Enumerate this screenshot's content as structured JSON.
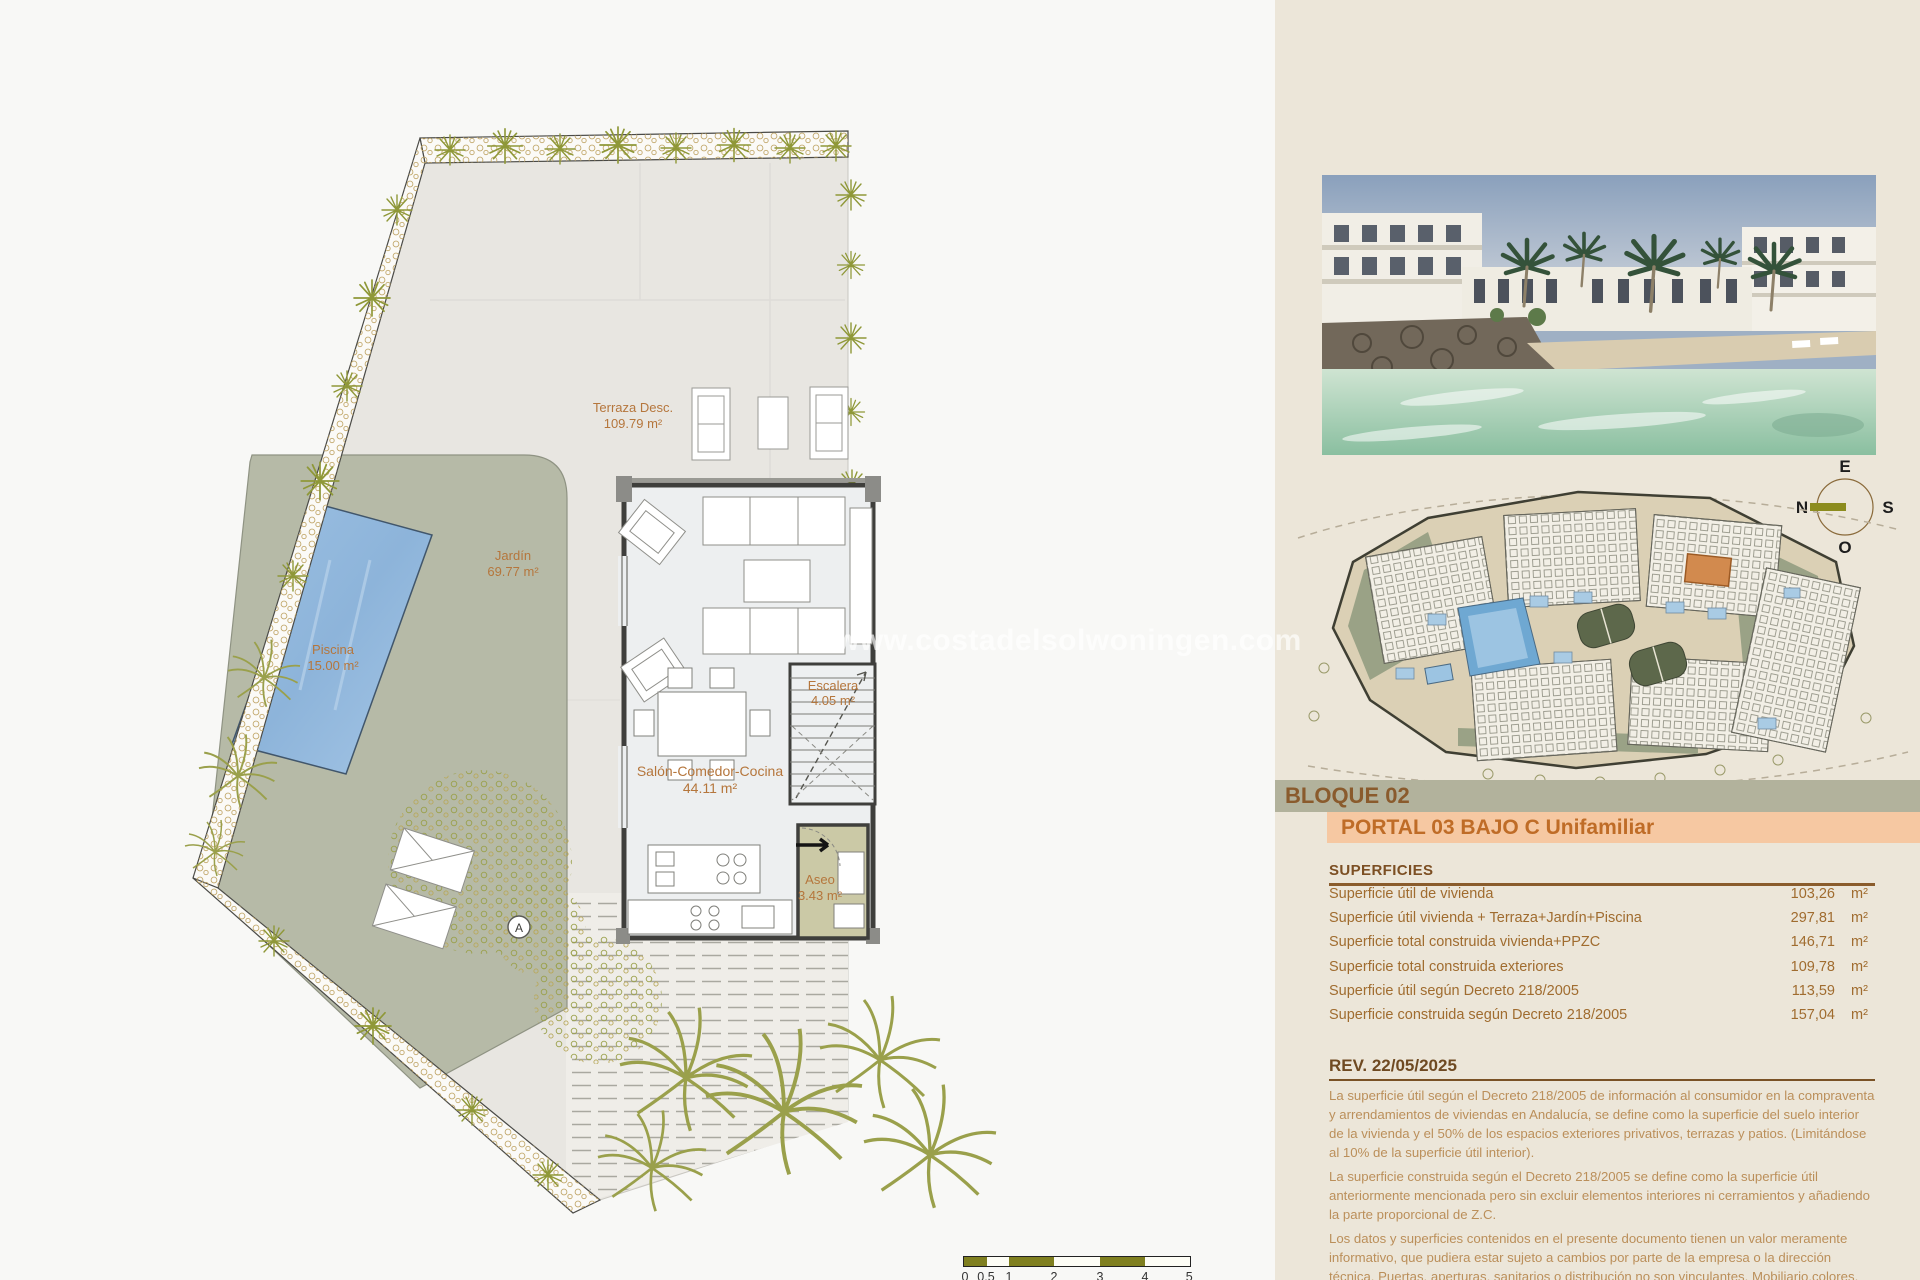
{
  "floorplan": {
    "rooms": {
      "terraza": {
        "label": "Terraza Desc.",
        "area": "109.79 m²"
      },
      "jardin": {
        "label": "Jardín",
        "area": "69.77 m²"
      },
      "piscina": {
        "label": "Piscina",
        "area": "15.00 m²"
      },
      "salon": {
        "label": "Salón-Comedor-Cocina",
        "area": "44.11 m²"
      },
      "escalera": {
        "label": "Escalera",
        "area": "4.05 m²"
      },
      "aseo": {
        "label": "Aseo",
        "area": "3.43 m²"
      }
    },
    "section_marker": "A",
    "watermark": "www.costadelsolwoningen.com",
    "scalebar": {
      "labels": [
        "0",
        "0.5",
        "1",
        "2",
        "3",
        "4",
        "5 m"
      ]
    }
  },
  "compass": {
    "top": "E",
    "left": "N",
    "right": "S",
    "bottom": "O"
  },
  "panel": {
    "bloque": "BLOQUE 02",
    "portal": "PORTAL 03 BAJO C Unifamiliar",
    "superficies": {
      "title": "SUPERFICIES",
      "rows": [
        {
          "label": "Superficie útil de vivienda",
          "value": "103,26",
          "unit": "m²"
        },
        {
          "label": "Superficie útil vivienda + Terraza+Jardín+Piscina",
          "value": "297,81",
          "unit": "m²"
        },
        {
          "label": "Superficie total construida vivienda+PPZC",
          "value": "146,71",
          "unit": "m²"
        },
        {
          "label": "Superficie total construida exteriores",
          "value": "109,78",
          "unit": "m²"
        },
        {
          "label": "Superficie útil según Decreto 218/2005",
          "value": "113,59",
          "unit": "m²"
        },
        {
          "label": "Superficie construida según Decreto 218/2005",
          "value": "157,04",
          "unit": "m²"
        }
      ]
    },
    "rev": {
      "title": "REV. 22/05/2025",
      "paragraphs": [
        "La superficie útil según el Decreto 218/2005 de información al consumidor en la compraventa y arrendamientos de viviendas en Andalucía, se define como la superficie del suelo interior de la vivienda y el 50% de los espacios exteriores privativos, terrazas y patios. (Limitándose al 10% de la superficie útil interior).",
        "La superficie construida según el Decreto 218/2005 se define como la superficie útil anteriormente mencionada pero sin excluir elementos interiores ni cerramientos y añadiendo la parte proporcional de Z.C.",
        "Los datos y superficies contenidos en el presente documento tienen un valor meramente informativo, que pudiera estar sujeto a cambios por parte de la empresa o la dirección técnica. Puertas, aperturas, sanitarios o distribución no son vinculantes. Mobiliario,colores, texturas o solería son únicamente gráficos orientativos, por lo que esta documentación no puede ser considerada como una forma de"
      ]
    }
  },
  "colors": {
    "accent_brown": "#9c6a33",
    "band_olive": "#b2b29c",
    "band_peach": "#f6c8a2",
    "pool_blue": "#93b9dd",
    "garden_green": "#b6baa7",
    "scale_olive": "#7f7f1f",
    "panel_beige": "#ece6d9"
  }
}
